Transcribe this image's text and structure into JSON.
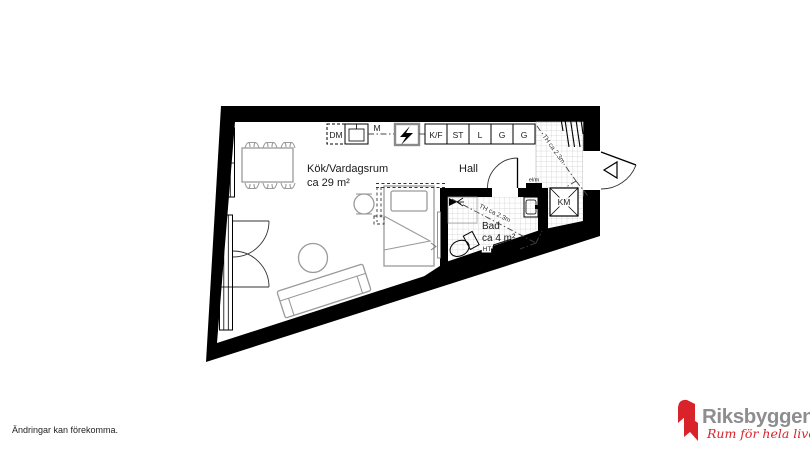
{
  "plan": {
    "rooms": {
      "livingroom": {
        "name": "Kök/Vardagsrum",
        "area": "ca 29 m²"
      },
      "hall": {
        "name": "Hall"
      },
      "bath": {
        "name": "Bad",
        "area": "ca 4 m²"
      }
    },
    "kitchen": {
      "dm": "DM",
      "m": "M",
      "kf": "K/F",
      "st": "ST",
      "l": "L",
      "g1": "G",
      "g2": "G"
    },
    "labels": {
      "th_hall": "TH ca 2.3m",
      "th_bath": "TH ca 2.3m",
      "km": "KM",
      "elm": "el/m",
      "ht": "HT"
    },
    "colors": {
      "wall": "#000000",
      "furniture": "#9a9a9a",
      "tile_line": "#cdcdcd",
      "label_text": "#1a1a1a"
    }
  },
  "footer": {
    "annotation": "Ändringar kan förekomma."
  },
  "logo": {
    "brand": "Riksbyggen",
    "tagline": "Rum för hela livet",
    "red": "#d8232a",
    "gray": "#8e8e91"
  }
}
